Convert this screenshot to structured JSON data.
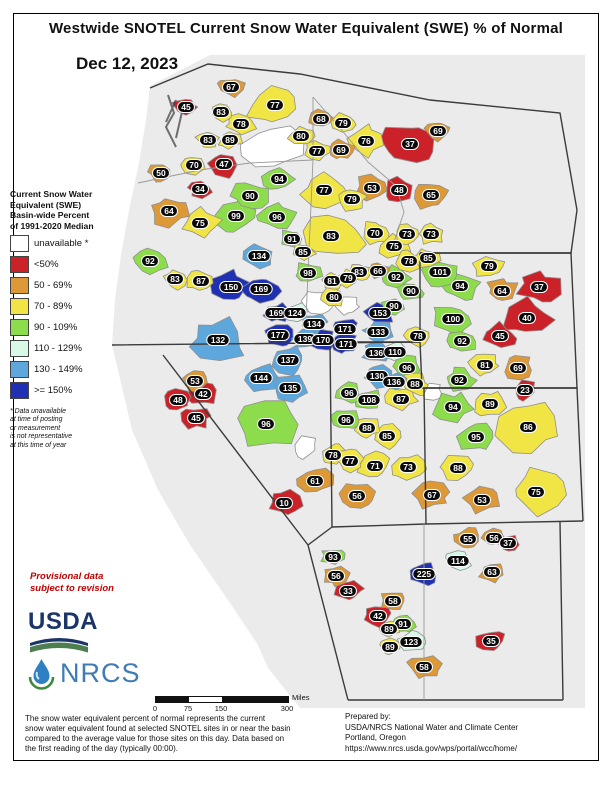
{
  "page": {
    "title": "Westwide SNOTEL Current Snow Water Equivalent (SWE) % of Normal",
    "date": "Dec 12, 2023"
  },
  "legend": {
    "title": "Current Snow Water\nEquivalent (SWE)\nBasin-wide Percent\nof 1991-2020 Median",
    "entries": [
      {
        "label": "unavailable *",
        "color": "#ffffff"
      },
      {
        "label": "<50%",
        "color": "#cb2128"
      },
      {
        "label": "50 - 69%",
        "color": "#dd9837"
      },
      {
        "label": "70 - 89%",
        "color": "#f1e545"
      },
      {
        "label": "90 - 109%",
        "color": "#8ddc4c"
      },
      {
        "label": "110 - 129%",
        "color": "#d7f9e6"
      },
      {
        "label": "130 - 149%",
        "color": "#5ea7dc"
      },
      {
        "label": ">= 150%",
        "color": "#2030b2"
      }
    ],
    "footnote": "*  Data unavailable\nat time of posting\nor measurement\nis not representative\nat this time of year"
  },
  "provisional_note": "Provisional data\nsubject to revision",
  "logos": {
    "usda": "USDA",
    "nrcs": "NRCS"
  },
  "scale_bar": {
    "ticks": [
      "0",
      "75",
      "150",
      "300"
    ],
    "unit": "Miles"
  },
  "footer": {
    "description": "The snow water equivalent percent of normal represents the current\nsnow water equivalent found at selected SNOTEL sites in or near the basin\ncompared to the average value for those sites on this day. Data based on\nthe first reading of the day (typically 00:00).",
    "prepared_by": "Prepared by:\nUSDA/NRCS National Water and Climate Center\nPortland, Oregon\nhttps://www.nrcs.usda.gov/wps/portal/wcc/home/"
  },
  "map": {
    "land_color": "#ebebeb",
    "border_color": "#3b3b3b",
    "basin_stroke": "#8f8f8f",
    "basins": [
      [
        67,
        231,
        87,
        10
      ],
      [
        45,
        186,
        107,
        10
      ],
      [
        83,
        221,
        112,
        10
      ],
      [
        77,
        275,
        105,
        22
      ],
      [
        78,
        241,
        124,
        11
      ],
      [
        68,
        321,
        119,
        10
      ],
      [
        79,
        343,
        123,
        10
      ],
      [
        76,
        366,
        141,
        15
      ],
      [
        37,
        410,
        144,
        22
      ],
      [
        69,
        438,
        131,
        10
      ],
      [
        83,
        208,
        140,
        9
      ],
      [
        89,
        230,
        140,
        9
      ],
      [
        80,
        301,
        136,
        10
      ],
      [
        77,
        317,
        151,
        10
      ],
      [
        69,
        341,
        150,
        10
      ],
      [
        70,
        194,
        165,
        11
      ],
      [
        47,
        224,
        164,
        13
      ],
      [
        50,
        161,
        173,
        10
      ],
      [
        34,
        200,
        189,
        9
      ],
      [
        94,
        279,
        179,
        12
      ],
      [
        77,
        324,
        190,
        18
      ],
      [
        53,
        372,
        188,
        13
      ],
      [
        48,
        399,
        190,
        12
      ],
      [
        65,
        431,
        195,
        15
      ],
      [
        79,
        352,
        199,
        12
      ],
      [
        64,
        169,
        211,
        15
      ],
      [
        90,
        250,
        196,
        15
      ],
      [
        99,
        236,
        216,
        15
      ],
      [
        96,
        277,
        217,
        14
      ],
      [
        75,
        200,
        223,
        15
      ],
      [
        91,
        292,
        239,
        10
      ],
      [
        85,
        303,
        252,
        9
      ],
      [
        83,
        331,
        236,
        26
      ],
      [
        92,
        150,
        261,
        15
      ],
      [
        83,
        175,
        279,
        10
      ],
      [
        87,
        201,
        281,
        11
      ],
      [
        134,
        259,
        256,
        12
      ],
      [
        150,
        231,
        287,
        16
      ],
      [
        169,
        261,
        289,
        14
      ],
      [
        98,
        308,
        273,
        11
      ],
      [
        83,
        359,
        272,
        9
      ],
      [
        66,
        378,
        271,
        9
      ],
      [
        81,
        332,
        281,
        9
      ],
      [
        79,
        348,
        278,
        9
      ],
      [
        80,
        334,
        297,
        10
      ],
      [
        92,
        396,
        277,
        11
      ],
      [
        90,
        411,
        291,
        10
      ],
      [
        90,
        394,
        306,
        9
      ],
      [
        70,
        375,
        233,
        12
      ],
      [
        73,
        407,
        234,
        11
      ],
      [
        73,
        431,
        234,
        11
      ],
      [
        75,
        394,
        246,
        12
      ],
      [
        78,
        409,
        261,
        10
      ],
      [
        85,
        428,
        258,
        10
      ],
      [
        101,
        440,
        272,
        14
      ],
      [
        79,
        489,
        266,
        12
      ],
      [
        94,
        460,
        286,
        15
      ],
      [
        64,
        502,
        291,
        13
      ],
      [
        37,
        539,
        287,
        16
      ],
      [
        40,
        527,
        318,
        20
      ],
      [
        45,
        500,
        336,
        13
      ],
      [
        100,
        453,
        319,
        16
      ],
      [
        92,
        462,
        341,
        12
      ],
      [
        78,
        418,
        336,
        11
      ],
      [
        153,
        380,
        313,
        12
      ],
      [
        133,
        378,
        332,
        11
      ],
      [
        136,
        376,
        353,
        10
      ],
      [
        110,
        395,
        352,
        9
      ],
      [
        169,
        276,
        313,
        10
      ],
      [
        124,
        295,
        313,
        10
      ],
      [
        134,
        314,
        324,
        10
      ],
      [
        171,
        345,
        329,
        10
      ],
      [
        177,
        278,
        335,
        11
      ],
      [
        139,
        305,
        339,
        10
      ],
      [
        170,
        323,
        340,
        10
      ],
      [
        171,
        346,
        344,
        10
      ],
      [
        132,
        218,
        340,
        22
      ],
      [
        137,
        288,
        360,
        14
      ],
      [
        144,
        261,
        378,
        14
      ],
      [
        135,
        290,
        388,
        13
      ],
      [
        96,
        266,
        424,
        24
      ],
      [
        53,
        195,
        381,
        10
      ],
      [
        42,
        203,
        394,
        11
      ],
      [
        48,
        178,
        400,
        10
      ],
      [
        45,
        196,
        418,
        11
      ],
      [
        10,
        284,
        503,
        13
      ],
      [
        130,
        377,
        376,
        11
      ],
      [
        136,
        394,
        382,
        9
      ],
      [
        88,
        415,
        384,
        11
      ],
      [
        96,
        407,
        368,
        12
      ],
      [
        96,
        349,
        393,
        10
      ],
      [
        108,
        369,
        400,
        11
      ],
      [
        87,
        401,
        399,
        12
      ],
      [
        96,
        346,
        420,
        11
      ],
      [
        88,
        367,
        428,
        11
      ],
      [
        85,
        387,
        436,
        12
      ],
      [
        78,
        333,
        455,
        11
      ],
      [
        77,
        350,
        461,
        11
      ],
      [
        71,
        375,
        466,
        13
      ],
      [
        73,
        408,
        467,
        13
      ],
      [
        61,
        315,
        481,
        14
      ],
      [
        56,
        357,
        496,
        13
      ],
      [
        81,
        485,
        365,
        12
      ],
      [
        69,
        518,
        368,
        13
      ],
      [
        23,
        525,
        390,
        10
      ],
      [
        92,
        459,
        380,
        12
      ],
      [
        94,
        453,
        407,
        15
      ],
      [
        89,
        490,
        404,
        13
      ],
      [
        86,
        528,
        427,
        26
      ],
      [
        95,
        476,
        437,
        15
      ],
      [
        88,
        458,
        468,
        13
      ],
      [
        67,
        432,
        495,
        14
      ],
      [
        53,
        482,
        500,
        13
      ],
      [
        75,
        536,
        492,
        22
      ],
      [
        93,
        333,
        557,
        9
      ],
      [
        56,
        336,
        576,
        10
      ],
      [
        33,
        348,
        591,
        11
      ],
      [
        225,
        424,
        574,
        12
      ],
      [
        55,
        468,
        539,
        12
      ],
      [
        114,
        458,
        561,
        10
      ],
      [
        56,
        494,
        538,
        9
      ],
      [
        37,
        508,
        543,
        9
      ],
      [
        63,
        492,
        572,
        10
      ],
      [
        58,
        393,
        601,
        10
      ],
      [
        42,
        378,
        616,
        11
      ],
      [
        91,
        403,
        624,
        9
      ],
      [
        89,
        389,
        629,
        8
      ],
      [
        123,
        411,
        642,
        11
      ],
      [
        89,
        390,
        647,
        8
      ],
      [
        58,
        424,
        667,
        13
      ],
      [
        35,
        491,
        641,
        11
      ]
    ],
    "unavailable_patches": [
      [
        272,
        148,
        24
      ],
      [
        318,
        303,
        12
      ],
      [
        348,
        306,
        10
      ],
      [
        432,
        392,
        9
      ],
      [
        305,
        447,
        11
      ]
    ]
  }
}
